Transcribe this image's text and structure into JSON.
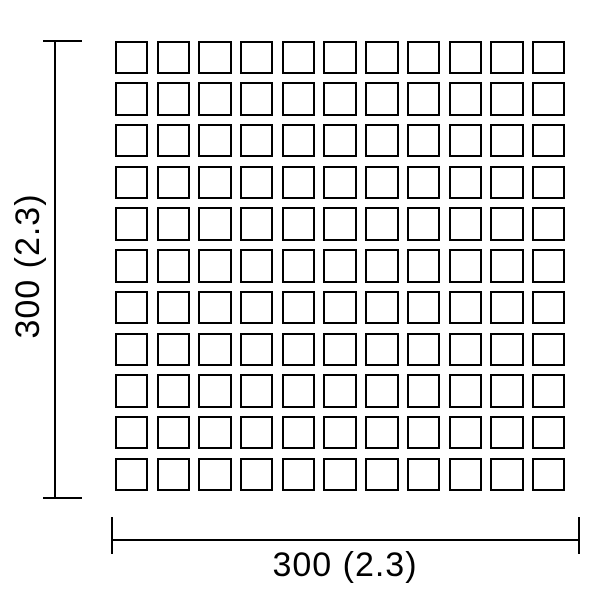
{
  "diagram": {
    "type": "dimension-drawing",
    "grid": {
      "rows": 11,
      "cols": 11
    },
    "labels": {
      "width": "300 (2.3)",
      "height": "300 (2.3)"
    },
    "colors": {
      "line": "#000000",
      "background": "#ffffff"
    }
  }
}
